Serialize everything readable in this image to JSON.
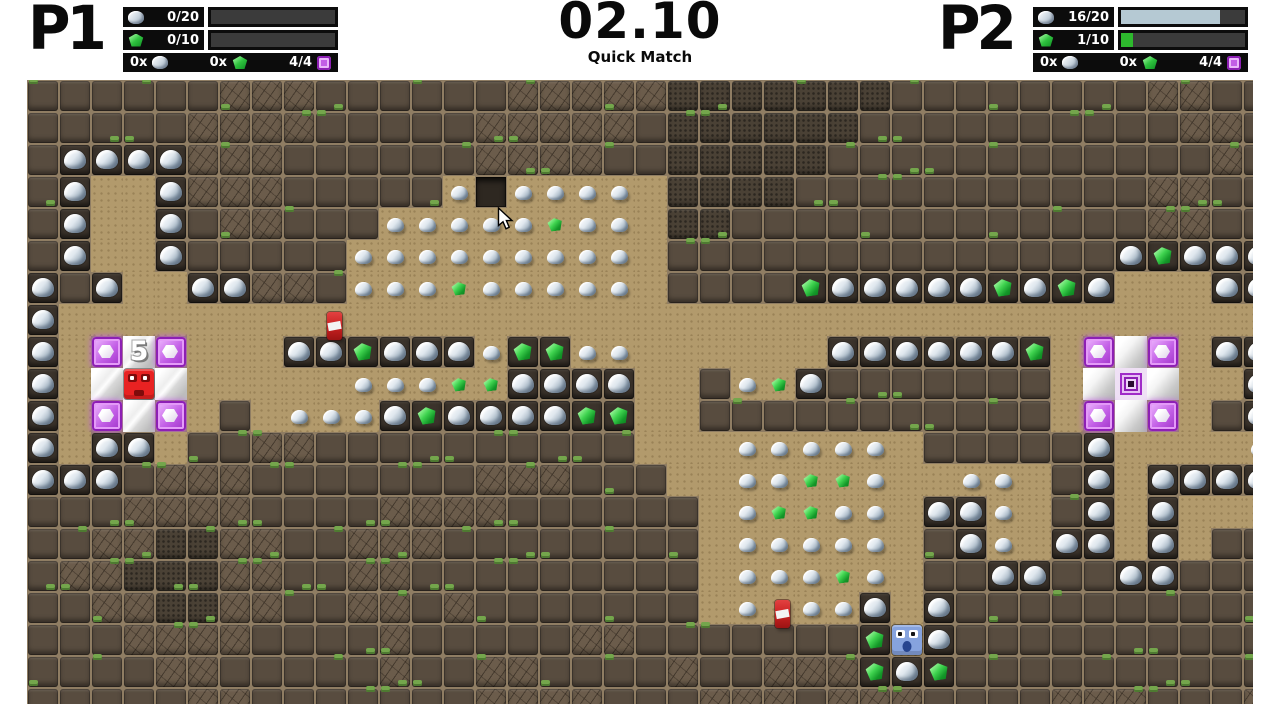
{
  "hud": {
    "p1": {
      "label": "P1",
      "rock": {
        "count": "0/20",
        "fill": 0
      },
      "gem": {
        "count": "0/10",
        "fill": 0
      },
      "totals": {
        "rock": "0x",
        "gem": "0x",
        "crystals": "4/4"
      }
    },
    "p2": {
      "label": "P2",
      "rock": {
        "count": "16/20",
        "fill": 0.8
      },
      "gem": {
        "count": "1/10",
        "fill": 0.1
      },
      "totals": {
        "rock": "0x",
        "gem": "0x",
        "crystals": "4/4"
      }
    },
    "timer": {
      "time": "02.10",
      "mode": "Quick Match"
    },
    "colors": {
      "rock_fill": "#b5c9d3",
      "gem_fill": "#2db82d",
      "bar_bg": "#3b3b3b",
      "crystal": "#c25ee6"
    }
  },
  "map": {
    "tile_size": 32,
    "origin": {
      "x": 27,
      "y": 80
    },
    "legend": {
      "#": {
        "name": "dirt-dark"
      },
      "%": {
        "name": "dirt-cracked"
      },
      "&": {
        "name": "dirt-mossy"
      },
      ".": {
        "name": "sand-floor"
      },
      "D": {
        "name": "dug-hole"
      },
      "R": {
        "name": "rock-in-dirt"
      },
      "G": {
        "name": "gem-in-dirt"
      },
      "r": {
        "name": "rock-item"
      },
      "g": {
        "name": "gem-item"
      },
      "P": {
        "name": "crystal-block"
      },
      "W": {
        "name": "shiny-tile"
      },
      "O": {
        "name": "portal"
      }
    },
    "rows": [
      "######%%%######%%%%%&&&&&&&########%%##",
      "#####%%%%#####%%%%%#&&&&&&##########%%#",
      "#RRRR%%%######%%%%##&&&&&############%#",
      "#R..R%%%#####rDrrrr.&&&&###########%%##",
      "#R..R#%%###rrrrrgrr.&&#############%%##",
      "#R..R#####rrrrrrrrr.##############RGRRR",
      "R#R..RR%%#rrrgrrrrr.####GRRRRRGRGR...RR",
      "R......................................",
      "R.PWP...RRGRRRrGGrr......RRRRRRG.PWP.RR",
      "R.WWW.....rrrggRRRR..#rgR#######.WOW..R",
      "R.PWP.#.rrrRGRRRRGG..###########.PWP.#R",
      "R.RR.##%%##########...rrrrr.#####R....r",
      "RRR#%%%#######%%%###..rrggr..rr.#R.RRRR",
      "###%%%%####%%%%######.rggrr.RRr.#R.R...",
      "##%%&&%%##%%%########.rrrrr.#Rr.RR.R.##",
      "#%%&&&%%##%%#########.rrrgr.##RR##RR###",
      "##%%&&%%##%%#%#######.r.rrR.R##########",
      "###%%%%####%#####%%#######G.R##########",
      "####%%#####%##%%####%##%%%GRG##########",
      "#####%%#######%%%%###%%%#%%%####%%%###%"
    ],
    "entities": [
      {
        "type": "player",
        "name": "player-red",
        "col": 3,
        "row": 9,
        "variant": "red"
      },
      {
        "type": "player",
        "name": "player-blue",
        "col": 27,
        "row": 17,
        "variant": "blue"
      },
      {
        "type": "flag",
        "name": "checkpoint-flag",
        "col": 9,
        "row": 7
      },
      {
        "type": "flag",
        "name": "checkpoint-flag",
        "col": 23,
        "row": 16
      },
      {
        "type": "countdown",
        "name": "respawn-countdown",
        "value": "5",
        "col": 3,
        "row": 8
      },
      {
        "type": "cursor",
        "name": "mouse-cursor",
        "x": 497,
        "y": 207
      }
    ]
  }
}
